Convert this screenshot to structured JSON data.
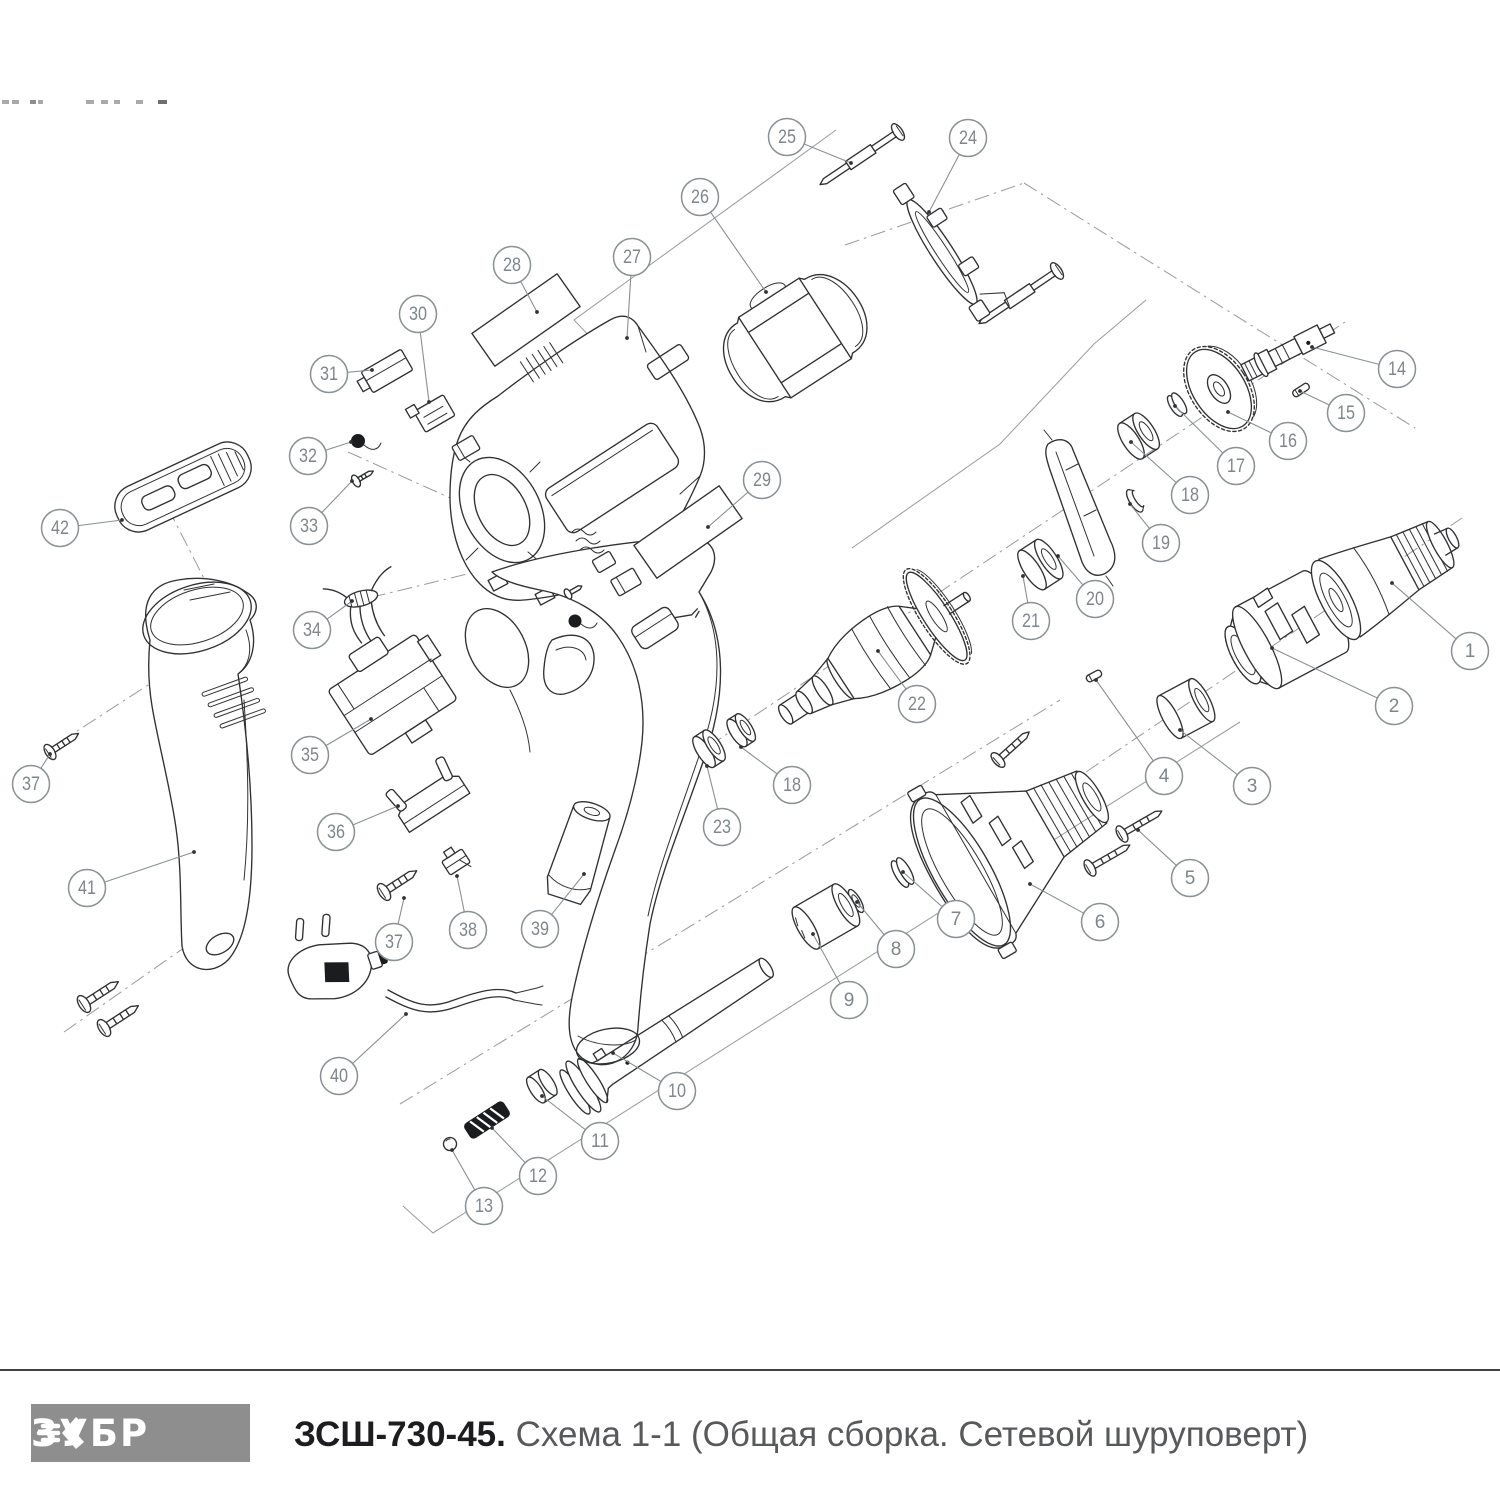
{
  "footer": {
    "brand": "ЗУБР",
    "model": "ЗСШ-730-45.",
    "caption": "Схема 1-1 (Общая сборка. Сетевой шуруповерт)",
    "logo_bg": "#8e8e8e",
    "rule_color": "#414244",
    "model_color": "#1d1d1f",
    "caption_color": "#58595b"
  },
  "diagram": {
    "title": "Общая сборка. Сетевой шуруповерт",
    "ink_color": "#303133",
    "construction_color": "#9b9ea1",
    "callout_color": "#8a9093",
    "callout_text_color": "#7f8689",
    "callout_radius": 18.5,
    "callouts": [
      {
        "n": "1",
        "x": 1470,
        "y": 651,
        "lx": 1392,
        "ly": 583
      },
      {
        "n": "2",
        "x": 1394,
        "y": 706,
        "lx": 1272,
        "ly": 648
      },
      {
        "n": "3",
        "x": 1252,
        "y": 786,
        "lx": 1180,
        "ly": 730
      },
      {
        "n": "4",
        "x": 1164,
        "y": 776,
        "lx": 1096,
        "ly": 680
      },
      {
        "n": "5",
        "x": 1190,
        "y": 878,
        "lx": 1138,
        "ly": 830
      },
      {
        "n": "6",
        "x": 1100,
        "y": 922,
        "lx": 1030,
        "ly": 884
      },
      {
        "n": "7",
        "x": 956,
        "y": 919,
        "lx": 903,
        "ly": 872
      },
      {
        "n": "8",
        "x": 896,
        "y": 949,
        "lx": 857,
        "ly": 902
      },
      {
        "n": "9",
        "x": 849,
        "y": 1000,
        "lx": 813,
        "ly": 934
      },
      {
        "n": "10",
        "x": 677,
        "y": 1091,
        "lx": 613,
        "ly": 1053
      },
      {
        "n": "11",
        "x": 600,
        "y": 1141,
        "lx": 542,
        "ly": 1096
      },
      {
        "n": "12",
        "x": 538,
        "y": 1176,
        "lx": 492,
        "ly": 1128
      },
      {
        "n": "13",
        "x": 484,
        "y": 1206,
        "lx": 452,
        "ly": 1150
      },
      {
        "n": "14",
        "x": 1397,
        "y": 369,
        "lx": 1312,
        "ly": 347
      },
      {
        "n": "15",
        "x": 1346,
        "y": 413,
        "lx": 1300,
        "ly": 391
      },
      {
        "n": "16",
        "x": 1288,
        "y": 441,
        "lx": 1228,
        "ly": 412
      },
      {
        "n": "17",
        "x": 1236,
        "y": 466,
        "lx": 1175,
        "ly": 406
      },
      {
        "n": "18",
        "x": 1190,
        "y": 495,
        "lx": 1131,
        "ly": 442
      },
      {
        "n": "19",
        "x": 1161,
        "y": 543,
        "lx": 1130,
        "ly": 504
      },
      {
        "n": "20",
        "x": 1095,
        "y": 599,
        "lx": 1058,
        "ly": 556
      },
      {
        "n": "21",
        "x": 1031,
        "y": 621,
        "lx": 1023,
        "ly": 576
      },
      {
        "n": "22",
        "x": 917,
        "y": 704,
        "lx": 878,
        "ly": 651
      },
      {
        "n": "23",
        "x": 722,
        "y": 827,
        "lx": 707,
        "ly": 766
      },
      {
        "n": "18",
        "x": 792,
        "y": 785,
        "lx": 741,
        "ly": 747
      },
      {
        "n": "24",
        "x": 968,
        "y": 138,
        "lx": 929,
        "ly": 212
      },
      {
        "n": "25",
        "x": 787,
        "y": 137,
        "lx": 851,
        "ly": 163
      },
      {
        "n": "26",
        "x": 700,
        "y": 197,
        "lx": 766,
        "ly": 292
      },
      {
        "n": "27",
        "x": 632,
        "y": 257,
        "lx": 627,
        "ly": 338
      },
      {
        "n": "28",
        "x": 512,
        "y": 265,
        "lx": 537,
        "ly": 312
      },
      {
        "n": "29",
        "x": 762,
        "y": 480,
        "lx": 708,
        "ly": 527
      },
      {
        "n": "30",
        "x": 418,
        "y": 314,
        "lx": 429,
        "ly": 402
      },
      {
        "n": "31",
        "x": 329,
        "y": 374,
        "lx": 372,
        "ly": 370
      },
      {
        "n": "32",
        "x": 308,
        "y": 456,
        "lx": 351,
        "ly": 442
      },
      {
        "n": "33",
        "x": 309,
        "y": 526,
        "lx": 352,
        "ly": 481
      },
      {
        "n": "34",
        "x": 312,
        "y": 630,
        "lx": 352,
        "ly": 601
      },
      {
        "n": "35",
        "x": 310,
        "y": 755,
        "lx": 371,
        "ly": 719
      },
      {
        "n": "36",
        "x": 336,
        "y": 832,
        "lx": 398,
        "ly": 806
      },
      {
        "n": "37",
        "x": 31,
        "y": 784,
        "lx": 50,
        "ly": 754
      },
      {
        "n": "38",
        "x": 468,
        "y": 930,
        "lx": 457,
        "ly": 876
      },
      {
        "n": "39",
        "x": 540,
        "y": 929,
        "lx": 584,
        "ly": 874
      },
      {
        "n": "40",
        "x": 339,
        "y": 1076,
        "lx": 406,
        "ly": 1014
      },
      {
        "n": "41",
        "x": 87,
        "y": 888,
        "lx": 194,
        "ly": 852
      },
      {
        "n": "37",
        "x": 394,
        "y": 942,
        "lx": 404,
        "ly": 898
      },
      {
        "n": "42",
        "x": 60,
        "y": 528,
        "lx": 122,
        "ly": 520
      }
    ]
  }
}
